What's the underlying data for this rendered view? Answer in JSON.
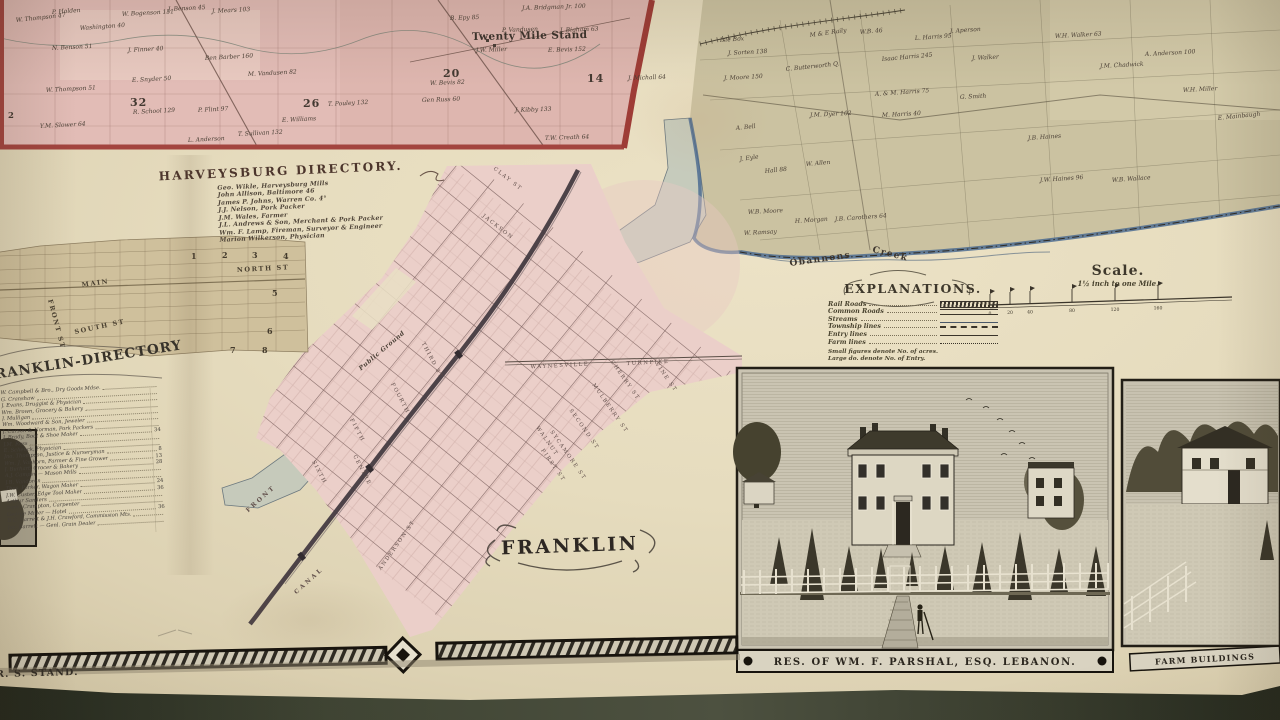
{
  "map": {
    "nw_township": {
      "sections": [
        "2",
        "32",
        "26",
        "20",
        "14"
      ],
      "place": "Twenty Mile Stand",
      "owners": [
        "W. Thompson 47",
        "P. Holden",
        "Washington 40",
        "W. Bogenson 151",
        "J. Benson 45",
        "J. Mears 103",
        "N. Benson 51",
        "J. Finner 40",
        "Ben Barber 160",
        "W. Thompson 51",
        "E. Snyder 50",
        "R. School 129",
        "P. Flint 97",
        "Y.M. Slower 64",
        "L. Anderson",
        "T. Sullivan 132",
        "M. Vandusen 82",
        "T. Pouley 132",
        "E. Williams",
        "B. Epy 85",
        "J.A. Bridgman Jr. 100",
        "P. Vandusen",
        "J.W. Miller",
        "E. Bevis 152",
        "J. Bigham 63",
        "W. Bevis 82",
        "Gen Russ 60",
        "J. Kibby 133",
        "T.W. Creath 64",
        "J. Michall 64"
      ]
    },
    "ne_township": {
      "owners": [
        "Isle Box",
        "J. Sorten 138",
        "M & E Raily",
        "W.B. 46",
        "L. Harris 95",
        "J. Aperson",
        "J. Moore 150",
        "C. Butterworth Q.",
        "Isaac Harris 245",
        "J. Walker",
        "A. & M. Harris 75",
        "G. Smith",
        "J.M. Dyer 102",
        "M. Harris 40",
        "A. Bell",
        "J. Eyle",
        "Hall 88",
        "W. Allen",
        "W.B. Moore",
        "H. Morgan",
        "W. Ramsay",
        "J.B. Carothers 64",
        "W.H. Walker 63",
        "A. Anderson 100",
        "J.M. Chadwick",
        "J.B. Haines",
        "J.W. Haines 96",
        "W.B. Wallace",
        "E. Mainbaugh",
        "W.H. Miller"
      ],
      "creek_word1": "Obannons",
      "creek_word2": "Creek"
    },
    "franklin": {
      "title": "FRANKLIN",
      "public_ground": "Public Ground",
      "turnpike_word1": "WAYNESVILLE",
      "turnpike_word2": "TURNPIKE",
      "streets": {
        "clay": "CLAY ST",
        "jackson": "JACKSON",
        "first": "FIRST ST",
        "second": "SECOND ST",
        "third": "THIRD ST",
        "fourth": "FOURTH",
        "fifth": "FIFTH",
        "sixth": "SIXTH",
        "centre": "CENTRE",
        "front": "FRONT",
        "canal": "CANAL",
        "anderson": "ANDERSON ST",
        "walnut": "WALNUT",
        "sycamore": "SYCAMORE ST",
        "mulberry": "MULBERRY ST",
        "cherry": "CHERRY ST",
        "vine": "VINE ST"
      }
    },
    "harveysburg": {
      "streets": {
        "main": "MAIN",
        "north": "NORTH ST",
        "south": "SOUTH ST",
        "front": "FRONT ST"
      },
      "blocks": [
        "1",
        "2",
        "3",
        "4",
        "5",
        "6",
        "7",
        "8"
      ]
    }
  },
  "harveysburg_directory": {
    "title": "HARVEYSBURG DIRECTORY.",
    "entries": [
      "Geo. Wikle, Harveysburg Mills",
      "John Allison, Baltimore 46",
      "James P. Johns, Warren Co. 4°",
      "J.J. Nelson, Pork Packer",
      "J.M. Wales, Farmer",
      "J.L. Andrews & Son, Merchant & Pork Packer",
      "Wm. F. Lamp, Fireman, Surveyor & Engineer",
      "Marion Wilkerson, Physician"
    ]
  },
  "franklin_directory": {
    "title": "RANKLIN-DIRECTORY",
    "entries": [
      {
        "t": "W. Campbell & Bro., Dry Goods Mdse.",
        "n": ""
      },
      {
        "t": "G. Cranshaw",
        "n": ""
      },
      {
        "t": "J. Evans, Druggist & Physician",
        "n": ""
      },
      {
        "t": "Wm. Brown, Grocery & Bakery",
        "n": ""
      },
      {
        "t": "J. Mulligan",
        "n": ""
      },
      {
        "t": "Wm. Woodward & Son, Jeweler",
        "n": ""
      },
      {
        "t": "J. Carson & Norman, Pork Packers",
        "n": ""
      },
      {
        "t": "J. Brady, Boot & Shoe Maker",
        "n": "34"
      },
      {
        "t": "J.M. Ross",
        "n": ""
      },
      {
        "t": "E. Schenck, Physician",
        "n": ""
      },
      {
        "t": "Jno. Thompson, Justice & Nurseryman",
        "n": "8"
      },
      {
        "t": "Wm. J. Vanhorn, Farmer & Fine Grower",
        "n": "13"
      },
      {
        "t": "J. Burhart, Grocer & Bakery",
        "n": "28"
      },
      {
        "t": "A.J. Camper — Mason Mills",
        "n": ""
      },
      {
        "t": "J.B. Vandoren",
        "n": ""
      },
      {
        "t": "Thos. Parker, Wagon Maker",
        "n": "24"
      },
      {
        "t": "J.W. Custer, Edge Tool Maker",
        "n": "36"
      },
      {
        "t": "Arthur Sanders",
        "n": ""
      },
      {
        "t": "Saml. Crampton, Carpenter",
        "n": ""
      },
      {
        "t": "George Miller — Hotel",
        "n": "36"
      },
      {
        "t": "D.C. Barrett & J.H. Crawford, Commission Mts.",
        "n": ""
      },
      {
        "t": "Jas. Barrett — Genl. Grain Dealer",
        "n": ""
      }
    ]
  },
  "explanations": {
    "title": "EXPLANATIONS.",
    "items": [
      {
        "label": "Rail Roads",
        "style": "rr"
      },
      {
        "label": "Common Roads",
        "style": "road"
      },
      {
        "label": "Streams",
        "style": "stream"
      },
      {
        "label": "Township lines",
        "style": "twp"
      },
      {
        "label": "Entry lines",
        "style": "entry"
      },
      {
        "label": "Farm lines",
        "style": "farm"
      }
    ],
    "note1": "Small figures denote No. of acres.",
    "note2": "Large do. denote No. of Entry."
  },
  "scale": {
    "title": "Scale.",
    "subtitle": "1½ inch to one Mile.",
    "ticks": [
      "0",
      "20",
      "40",
      "80",
      "120",
      "160"
    ]
  },
  "engravings": {
    "residence_caption": "RES. OF WM. F. PARSHAL, ESQ. LEBANON.",
    "farm_caption": "FARM BUILDINGS",
    "stand_caption": "R. S. STAND."
  }
}
